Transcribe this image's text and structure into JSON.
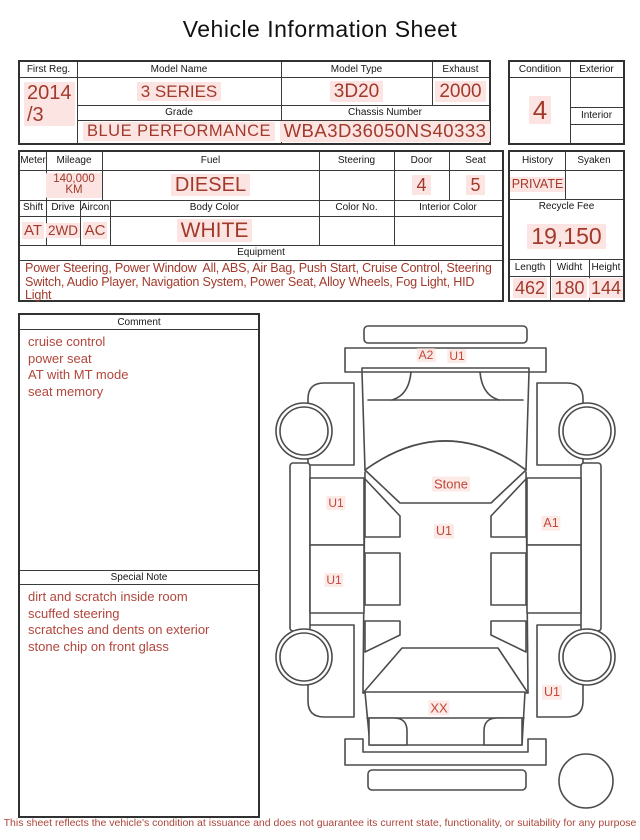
{
  "title": "Vehicle Information Sheet",
  "header_table": {
    "first_reg_label": "First Reg.",
    "first_reg_value": "2014\n/3",
    "model_name_label": "Model Name",
    "model_name_value": "3 SERIES",
    "model_type_label": "Model Type",
    "model_type_value": "3D20",
    "exhaust_label": "Exhaust",
    "exhaust_value": "2000",
    "grade_label": "Grade",
    "grade_value": "BLUE PERFORMANCE",
    "chassis_label": "Chassis Number",
    "chassis_value": "WBA3D36050NS40333"
  },
  "condition_table": {
    "condition_label": "Condition",
    "condition_value": "4",
    "exterior_label": "Exterior",
    "exterior_value": "",
    "interior_label": "Interior",
    "interior_value": ""
  },
  "spec_table": {
    "meter_label": "Meter",
    "meter_value": "",
    "mileage_label": "Mileage",
    "mileage_value": "140,000 KM",
    "fuel_label": "Fuel",
    "fuel_value": "DIESEL",
    "steering_label": "Steering",
    "steering_value": "",
    "door_label": "Door",
    "door_value": "4",
    "seat_label": "Seat",
    "seat_value": "5",
    "shift_label": "Shift",
    "shift_value": "AT",
    "drive_label": "Drive",
    "drive_value": "2WD",
    "aircon_label": "Aircon",
    "aircon_value": "AC",
    "body_color_label": "Body Color",
    "body_color_value": "WHITE",
    "color_no_label": "Color No.",
    "color_no_value": "",
    "interior_color_label": "Interior Color",
    "interior_color_value": "",
    "equipment_label": "Equipment",
    "equipment_value": "Power Steering, Power Window  All, ABS, Air Bag, Push Start, Cruise Control, Steering Switch, Audio Player, Navigation System, Power Seat, Alloy Wheels, Fog Light, HID Light"
  },
  "history_table": {
    "history_label": "History",
    "history_value": "PRIVATE",
    "syaken_label": "Syaken",
    "syaken_value": "",
    "recycle_fee_label": "Recycle Fee",
    "recycle_fee_value": "19,150",
    "length_label": "Length",
    "length_value": "462",
    "width_label": "Widht",
    "width_value": "180",
    "height_label": "Height",
    "height_value": "144"
  },
  "comment_box": {
    "title": "Comment",
    "lines": [
      "cruise control",
      "power seat",
      "AT with MT mode",
      "seat memory"
    ]
  },
  "special_note_box": {
    "title": "Special Note",
    "lines": [
      "dirt and scratch inside room",
      "scuffed steering",
      "scratches and dents on exterior",
      "stone chip on front glass"
    ]
  },
  "diagram": {
    "front_bumper_marker_a2": "A2",
    "front_bumper_marker_u1": "U1",
    "windshield_marker": "Stone",
    "left_front_door_marker": "U1",
    "roof_marker": "U1",
    "right_front_door_marker": "A1",
    "left_rear_door_marker": "U1",
    "right_rear_fender_marker": "U1",
    "trunk_marker": "XX"
  },
  "footer": "This sheet reflects the vehicle's condition at issuance and does not guarantee its current state, functionality, or suitability for any purpose",
  "colors": {
    "value_red": "#a23a2c",
    "marker_red": "#c2483c",
    "highlight_pink": "#fbe4e2"
  }
}
